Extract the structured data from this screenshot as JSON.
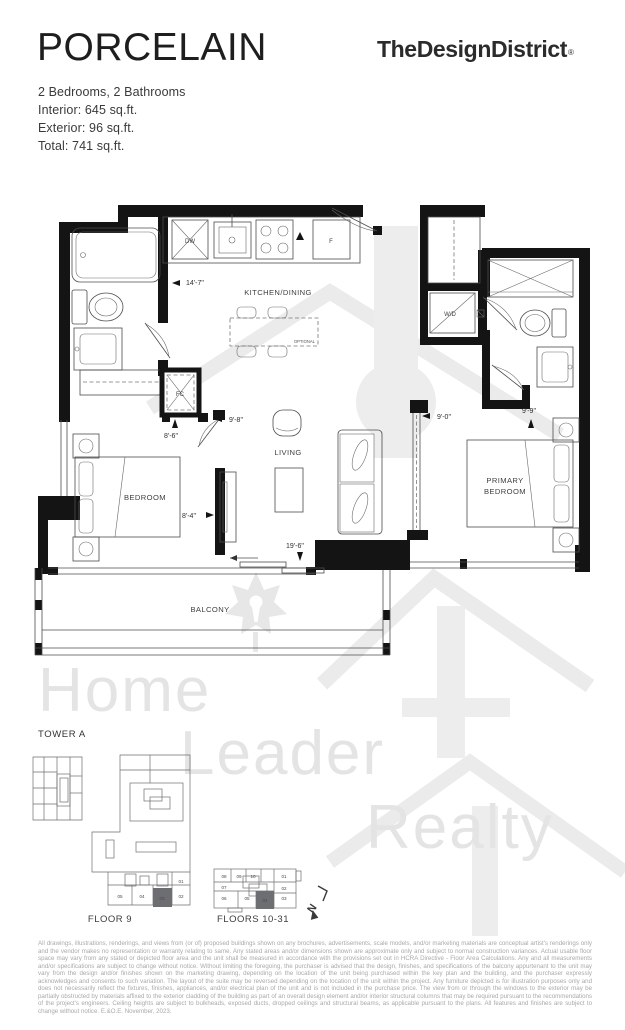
{
  "header": {
    "title": "PORCELAIN",
    "brand": "TheDesignDistrict",
    "registered_mark": "®",
    "specs": [
      "2 Bedrooms, 2 Bathrooms",
      "Interior: 645 sq.ft.",
      "Exterior: 96 sq.ft.",
      "Total: 741 sq.ft."
    ]
  },
  "floorplan": {
    "room_labels": {
      "kitchen_dining": "KITCHEN/DINING",
      "living": "LIVING",
      "bedroom": "BEDROOM",
      "primary_line1": "PRIMARY",
      "primary_line2": "BEDROOM",
      "balcony": "BALCONY"
    },
    "fixture_labels": {
      "dishwasher": "DW",
      "fridge": "F",
      "fan_coil": "FC",
      "washer_dryer": "W/D",
      "optional": "OPTIONAL"
    },
    "dimensions": {
      "kitchen_width": "14'-7\"",
      "dining_depth": "9'-8\"",
      "bedroom_width": "8'-6\"",
      "bedroom_depth": "8'-4\"",
      "balcony_width": "19'-6\"",
      "living_width": "9'-0\"",
      "primary_width": "9'-9\""
    }
  },
  "keyplans": {
    "tower_label": "TOWER A",
    "floor9": {
      "label": "FLOOR 9",
      "units": [
        "01",
        "02",
        "03",
        "04",
        "05"
      ],
      "highlighted_unit": "03"
    },
    "floors_10_31": {
      "label": "FLOORS 10-31",
      "units": [
        "08",
        "09",
        "10",
        "01",
        "07",
        "02",
        "06",
        "05",
        "04",
        "03"
      ],
      "highlighted_unit": "04"
    },
    "north_label": "N",
    "highlight_color": "#6d6e71"
  },
  "watermark": {
    "line1": "Home",
    "line2": "Leader",
    "line3": "Realty"
  },
  "legal_text": "All drawings, illustrations, renderings, and views from (or of) proposed buildings shown on any brochures, advertisements, scale models, and/or marketing materials are conceptual artist's renderings only and the vendor makes no representation or warranty relating to same. Any stated areas and/or dimensions shown are approximate only and subject to normal construction variances. Actual usable floor space may vary from any stated or depicted floor area and the unit shall be measured in accordance with the provisions set out in HCRA Directive - Floor Area Calculations. Any and all measurements and/or specifications are subject to change without notice. Without limiting the foregoing, the purchaser is advised that the design, finishes, and specifications of the balcony appurtenant to the unit may vary from the design and/or finishes shown on the marketing drawing, depending on the location of the unit being purchased within the key plan and the building, and the purchaser expressly acknowledges and consents to such variation. The layout of the suite may be reversed depending on the location of the unit within the project. Any furniture depicted is for illustration purposes only and does not necessarily reflect the fixtures, finishes, appliances, and/or electrical plan of the unit and is not included in the purchase price. The view from or through the windows to the exterior may be partially obstructed by materials affixed to the exterior cladding of the building as part of an overall design element and/or interior structural columns that may be required pursuant to the recommendations of the project's engineers. Ceiling heights are subject to bulkheads, exposed ducts, dropped ceilings and structural beams, as applicable pursuant to the plans. All features and finishes are subject to change without notice. E.&O.E. November, 2023."
}
